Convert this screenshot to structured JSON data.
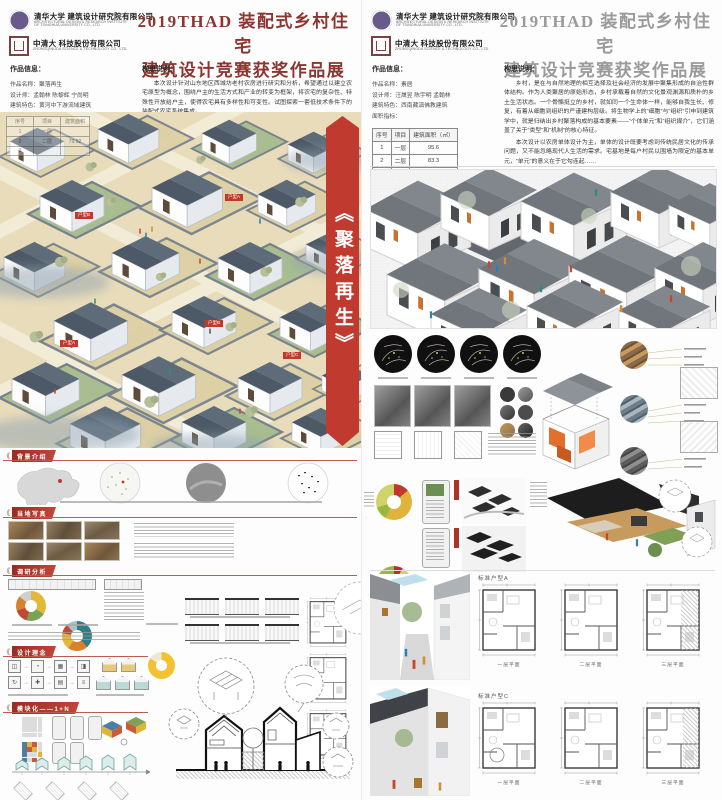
{
  "shared": {
    "org1_cn": "清华大学 建筑设计研究院有限公司",
    "org1_en1": "ARCHITECTURAL DESIGN & RESEARCH INSTITUTE",
    "org1_en2": "OF TSINGHUA UNIVERSITY CO., LTD.",
    "org2_cn": "中清大 科技股份有限公司",
    "org2_en1": "ZHONGQINGDA SCIENCE & TECHNOLOGY CO., LTD.",
    "title_line1": "2019THAD 装配式乡村住宅",
    "title_line2": "建筑设计竞赛获奖作品展",
    "section_mark": "《"
  },
  "left": {
    "info_heading": "作品信息：",
    "info_name": "作品名称：聚落再生",
    "info_designer": "设计师：孟翰林 陈黎辉 宁尚明",
    "info_feature": "建筑特色：黄河中下游流域建筑",
    "info_area": "面积指标：",
    "concept_heading": "构思说明：",
    "concept_text": "本次设计针对山东地区西城坊老村农房进行研究和分析，希望通过以建立农宅原型为概念，围绕户主的生活方式和产业的转变为框架，将农宅的复杂性、特殊性开放给户主，使得农宅具有多样性和可变性。试图探索一套低技术条件下的装配式农宅系统集成。",
    "banner_text": "《聚落再生》",
    "tags": {
      "a": "户型A",
      "b": "户型B",
      "c": "户型C"
    },
    "overlay_table": {
      "headers": [
        "序号",
        "项目",
        "建筑面积"
      ],
      "rows": [
        [
          "1",
          "一层",
          ""
        ],
        [
          "2",
          "二层",
          "79.92"
        ],
        [
          "3",
          "",
          ""
        ]
      ]
    },
    "sections": {
      "s1": "背景介绍",
      "s2": "当地写真",
      "s3": "调研分析",
      "s4": "设计理念",
      "s5": "模块化——1+N"
    },
    "flow_icons": [
      "◫",
      "◔",
      "▦",
      "◨",
      "⌂",
      "↻",
      "✚",
      "▤",
      "◧",
      "≡"
    ],
    "colors": {
      "banner_red": "#c13a2f",
      "title_maroon": "#8c3530",
      "village_ground": "#e9dcba",
      "village_roof": "#4f5b68",
      "section_bar_red": "#a33026"
    },
    "charts": {
      "survey_donut_1_colors": [
        "#e3b93a",
        "#79a357",
        "#bf4936",
        "#d9822e",
        "#cfcfcf"
      ],
      "survey_donut_2_colors": [
        "#2e7f86",
        "#d9822e",
        "#e3b93a",
        "#bf4936",
        "#a9c2c6"
      ],
      "survey_donut_3_colors": [
        "#f2c230",
        "#efe8d6"
      ]
    }
  },
  "right": {
    "info_heading": "作品信息：",
    "info_name": "作品名称：素居",
    "info_designer": "设计师：汪晟昱 陈宇明 孟翰林",
    "info_feature": "建筑特色：西南藏滇佛教建筑",
    "info_area": "面积指标：",
    "table": {
      "headers": [
        "序号",
        "项目",
        "建筑面积（㎡）"
      ],
      "rows": [
        [
          "1",
          "一层",
          "95.6"
        ],
        [
          "2",
          "二层",
          "83.3"
        ],
        [
          "3",
          "三层",
          "55.8"
        ],
        [
          "4",
          "合计",
          "234.7"
        ]
      ]
    },
    "concept_heading": "构思说明：",
    "concept_p1": "乡村，是在与自然地理的相互选择及社会经济的发展中聚集形成的自治性群体结构。作为人类聚居的原始形态，乡村承载着自然的文化景观渊源和质朴的乡土生活状态。一个骨骼挺立的乡村，就如同一个生命体一样，能够自我生长、修复，有着从细胞到组织的严谨建构层级。将生物学上的“细胞”与“组织”引申到建筑学中，就是归纳出乡村聚落构成的基本要素——“个体单元”和“组织媒介”，它们涵盖了关于“类型”和“机制”的核心特征。",
    "concept_p2": "本次设计以农房单体设计为主，单体的设计既要考虑到传统民居文化的传承问题，又不能忽略现代人生活的需求。宅基地是每户村民以围墙为限定的基本单元，“单元”的意义在于它勾连起……",
    "plan_row1_label": "标准户型A",
    "plan_row2_label": "标准户型C",
    "plan_captions": [
      "一层平面",
      "二层平面",
      "三层平面"
    ],
    "colors": {
      "title_gray": "#9a9a9a",
      "render_roof": "#70767b",
      "accent_orange": "#e2702c"
    },
    "charts": {
      "analysis_donut_colors": [
        "#c0392b",
        "#e9b63c",
        "#8faa3e"
      ],
      "type_a_donut_colors": [
        "#c0392b",
        "#e0b33a",
        "#9ab83e",
        "#cfd36a"
      ],
      "type_c_donut_colors": [
        "#b5342a",
        "#cfd36a",
        "#e0b33a",
        "#9ab83e"
      ]
    }
  }
}
